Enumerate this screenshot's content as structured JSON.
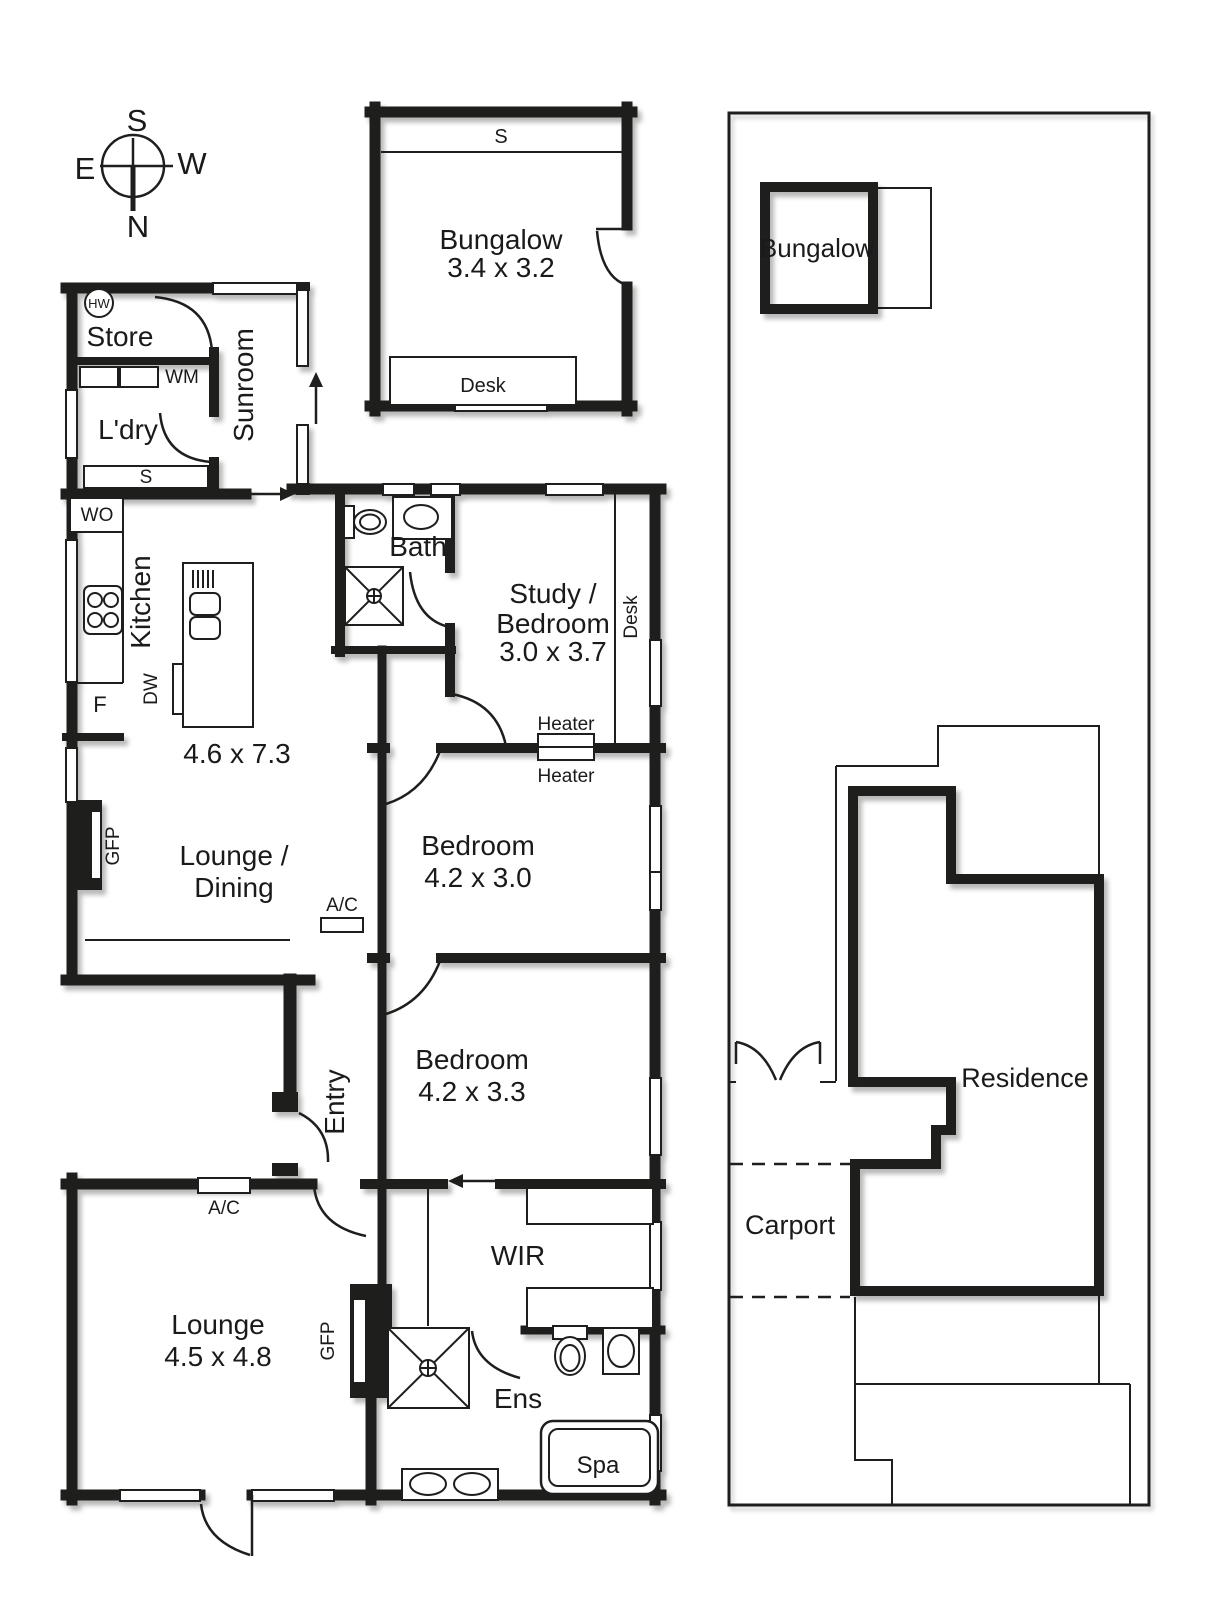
{
  "compass": {
    "top": "S",
    "left": "E",
    "right": "W",
    "bottom": "N"
  },
  "bungalow_plan": {
    "shelf": "S",
    "name": "Bungalow",
    "dims": "3.4 x 3.2",
    "desk": "Desk"
  },
  "floor_plan": {
    "hw": "HW",
    "store": "Store",
    "wm": "WM",
    "laundry": "L'dry",
    "shelf": "S",
    "sunroom": "Sunroom",
    "wo": "WO",
    "kitchen": "Kitchen",
    "fridge": "F",
    "dw": "DW",
    "kitchen_dims": "4.6 x 7.3",
    "bath": "Bath",
    "study1": "Study /",
    "study2": "Bedroom",
    "study_dims": "3.0 x 3.7",
    "desk": "Desk",
    "heater1": "Heater",
    "heater2": "Heater",
    "lounge_dining1": "Lounge /",
    "lounge_dining2": "Dining",
    "gfp1": "GFP",
    "ac1": "A/C",
    "bed1": "Bedroom",
    "bed1_dims": "4.2 x 3.0",
    "bed2": "Bedroom",
    "bed2_dims": "4.2 x 3.3",
    "entry": "Entry",
    "ac2": "A/C",
    "lounge": "Lounge",
    "lounge_dims": "4.5 x 4.8",
    "gfp2": "GFP",
    "wir": "WIR",
    "ens": "Ens",
    "spa": "Spa"
  },
  "site_plan": {
    "bungalow": "Bungalow",
    "residence": "Residence",
    "carport": "Carport"
  }
}
